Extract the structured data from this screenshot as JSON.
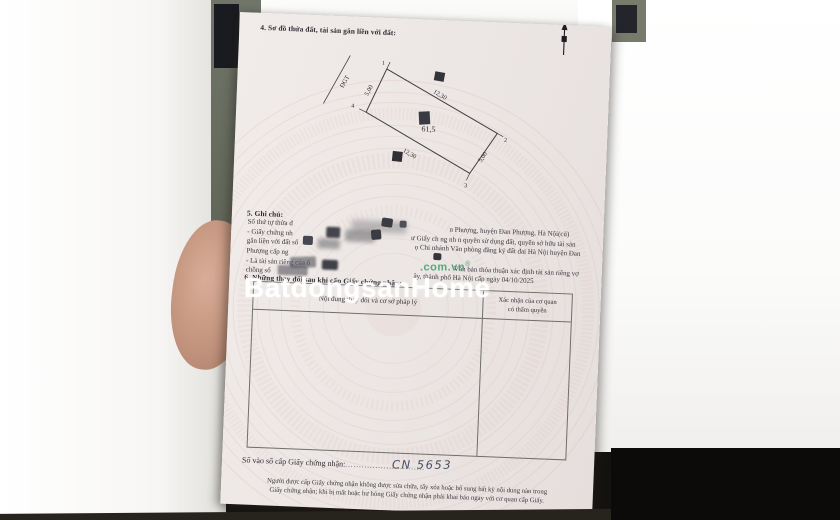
{
  "section4": {
    "heading": "4. Sơ đồ thửa đất, tài sản gắn liền với đất:"
  },
  "diagram": {
    "corner1": "1",
    "corner2": "2",
    "corner3": "3",
    "corner4": "4",
    "top_length": "12,30",
    "bottom_length": "12,30",
    "left_length": "5,00",
    "right_length": "5,00",
    "area": "61,5",
    "road_label": "ĐGT"
  },
  "section5": {
    "heading": "5. Ghi chú:",
    "lines": [
      {
        "left": "Số thứ tự thửa đ",
        "right": "n Phượng, huyện Đan Phượng, Hà Nội(cũ)"
      },
      {
        "left": "- Giấy chứng nh",
        "right": "ư Giấy ch ng nh n quyền sử dụng đất, quyền sở hữu tài sản"
      },
      {
        "left": "gắn liền với đất số",
        "right": "ọ Chi nhánh Văn phòng đăng ký đất đai Hà Nội huyện Đan"
      },
      {
        "left": "Phượng cấp ng",
        "right": ""
      },
      {
        "left": "- Là tài sản riêng của ô",
        "right": "Văn bản thỏa thuận xác định tài sản riêng vợ"
      },
      {
        "left": "chồng số",
        "right": "ây, thành phố Hà Nội cấp ngày 04/10/2025"
      }
    ]
  },
  "section6": {
    "heading": "6. Những thay đổi sau khi cấp Giấy chứng nhận:",
    "table": {
      "col1": "Nội dung thay đổi và cơ sở pháp lý",
      "col2a": "Xác nhận của cơ quan",
      "col2b": "có thẩm quyền"
    }
  },
  "registry": {
    "label": "Số vào sổ cấp Giấy chứng nhận:",
    "dots1": "................",
    "number": "CN 5653",
    "dots2": "............."
  },
  "footer": {
    "line1": "Người được cấp Giấy chứng nhận không được sửa chữa, tẩy xóa hoặc bổ sung bất kỳ nội dung nào trong",
    "line2": "Giấy chứng nhận; khi bị mất hoặc hư hỏng Giấy chứng nhận phải khai báo ngay với cơ quan cấp Giấy."
  },
  "watermark": {
    "text": "BatdongsanHome",
    "domain": ".com.vn",
    "reg": "®",
    "green": "#389e68"
  }
}
